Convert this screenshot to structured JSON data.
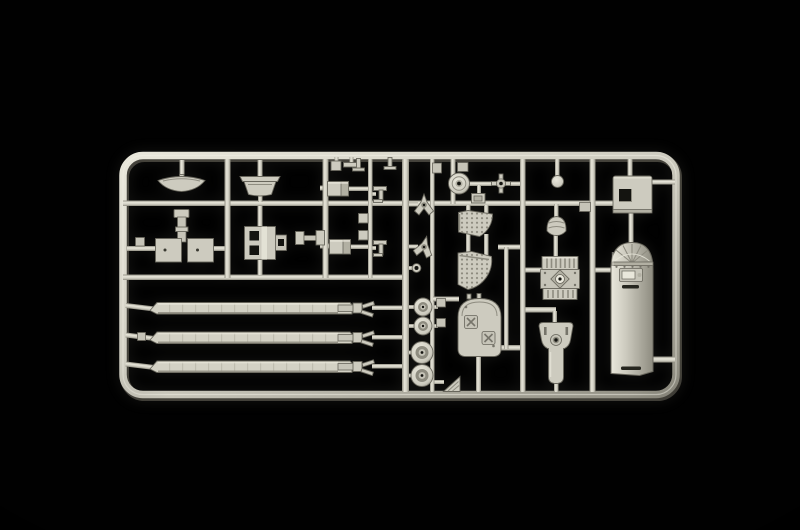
{
  "scene": {
    "description": "Product photograph of a light grey injection-moulded model kit sprue (parts runner frame) for a helicopter kit, shot on a pure black studio background with soft light from the upper left",
    "subject": "plastic model kit sprue",
    "background": "pure black",
    "frame_shape": "rounded rectangular runner frame with internal vertical and horizontal runners"
  },
  "colors": {
    "bg": "#010101",
    "plastic": "#cdcbbf",
    "plastic-light": "#e9e7db",
    "plastic-mid": "#b2b0a3",
    "plastic-soft": "#c6c4b8",
    "plastic-dark": "#8e8c80",
    "plastic-deep": "#625f55",
    "outline": "#68665c",
    "hole": "#141410",
    "blade": "#d3d1c4"
  },
  "parts": [
    {
      "name": "visor-dish",
      "desc": "small curved crescent dish"
    },
    {
      "name": "tub-pan",
      "desc": "flanged tub-shaped pan"
    },
    {
      "name": "seat-column-base",
      "desc": "control column on split base plate"
    },
    {
      "name": "bracket-plate",
      "desc": "bracket with two square openings and side flange"
    },
    {
      "name": "link-rod",
      "desc": "small dumbbell link"
    },
    {
      "name": "equipment-box-a",
      "desc": "rectangular equipment box"
    },
    {
      "name": "equipment-box-b",
      "desc": "rectangular equipment box"
    },
    {
      "name": "t-lever-a",
      "desc": "small T-shaped lever"
    },
    {
      "name": "t-lever-b",
      "desc": "small T-shaped lever"
    },
    {
      "name": "mount-square-a",
      "desc": "small square mount"
    },
    {
      "name": "mount-square-b",
      "desc": "small square mount"
    },
    {
      "name": "tripod-hub-a",
      "desc": "three-armed hub"
    },
    {
      "name": "tripod-hub-b",
      "desc": "three-armed hub"
    },
    {
      "name": "small-ring",
      "desc": "tiny ring eyelet"
    },
    {
      "name": "pulley-wheel-small-a",
      "desc": "small wheel"
    },
    {
      "name": "pulley-wheel-small-b",
      "desc": "small wheel"
    },
    {
      "name": "wheel-large-a",
      "desc": "large wheel"
    },
    {
      "name": "wheel-large-b",
      "desc": "large wheel"
    },
    {
      "name": "wedge-plate",
      "desc": "triangular hatched wedge"
    },
    {
      "name": "rotor-hub-disc",
      "desc": "disc with centre bore"
    },
    {
      "name": "cross-pulley",
      "desc": "hub with four cross stubs"
    },
    {
      "name": "junction-box",
      "desc": "small junction box"
    },
    {
      "name": "perforated-quarter-panel",
      "desc": "perforated fan-shaped floor panel"
    },
    {
      "name": "perforated-curved-panel",
      "desc": "perforated curved floor panel"
    },
    {
      "name": "bulkhead-x-panel",
      "desc": "arch-top bulkhead with X-brace plates"
    },
    {
      "name": "ball-joint",
      "desc": "small ball"
    },
    {
      "name": "pod-fairing",
      "desc": "small domed pod"
    },
    {
      "name": "engine-block",
      "desc": "ribbed engine block with diamond plate"
    },
    {
      "name": "gearbox-housing",
      "desc": "gearbox housing with output shaft"
    },
    {
      "name": "window-panel",
      "desc": "access panel with square window opening"
    },
    {
      "name": "door-panel",
      "desc": "long arched door panel with vent slots"
    },
    {
      "name": "rotor-blade-1",
      "desc": "long main rotor blade with root fork"
    },
    {
      "name": "rotor-blade-2",
      "desc": "long main rotor blade with root fork"
    },
    {
      "name": "rotor-blade-3",
      "desc": "long main rotor blade with root fork"
    }
  ]
}
